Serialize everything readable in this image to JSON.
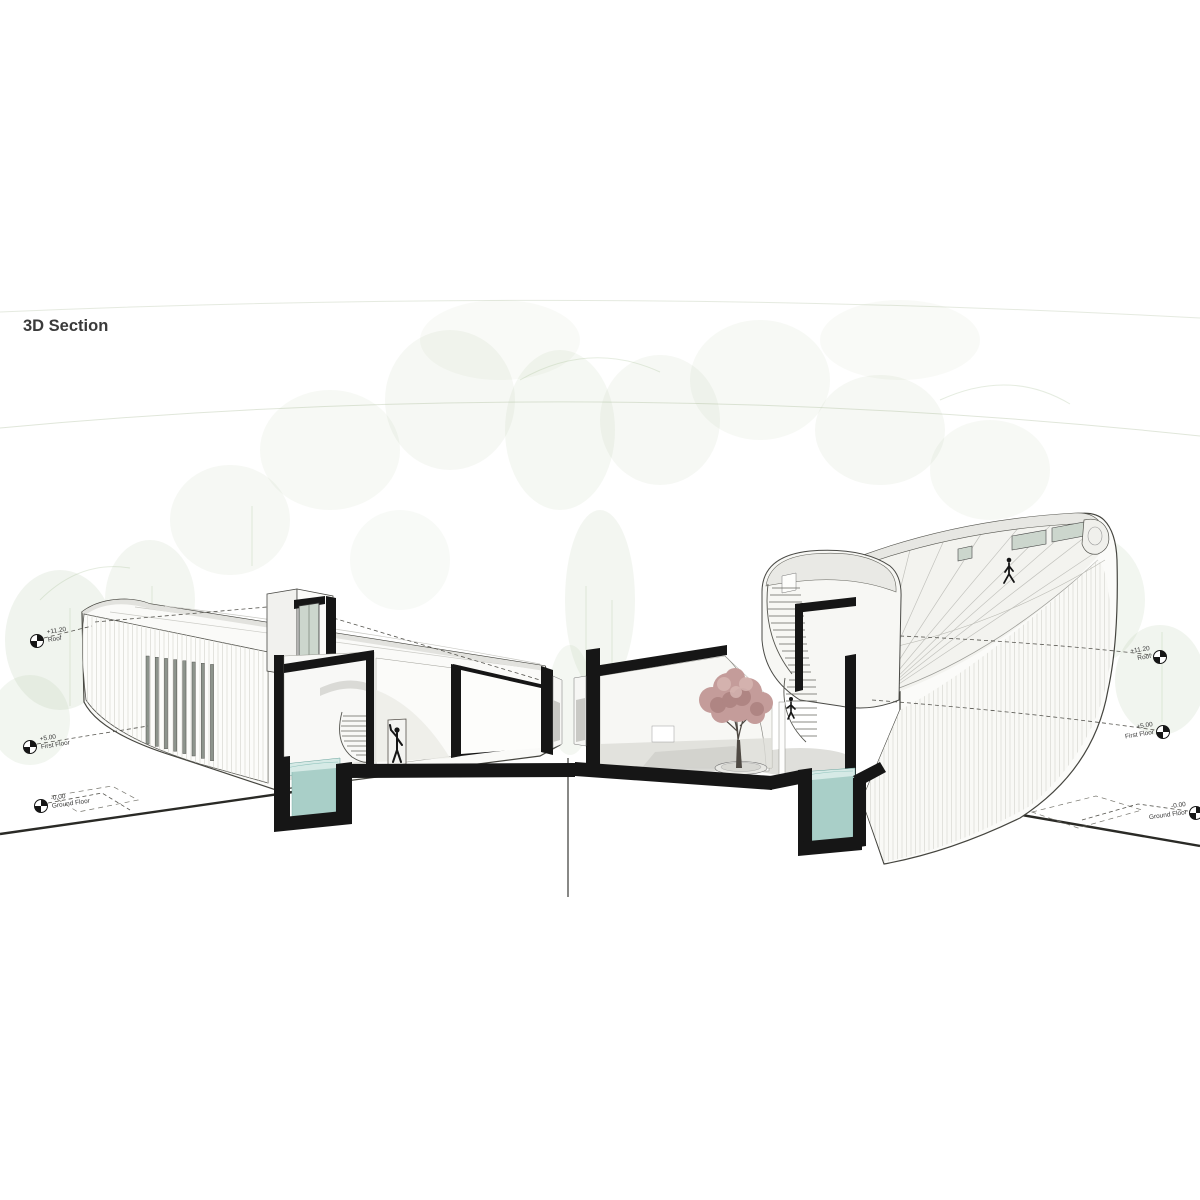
{
  "title": "3D Section",
  "levels": {
    "left": [
      {
        "value": "+11.20",
        "label": "Roof"
      },
      {
        "value": "+5.00",
        "label": "First Floor"
      },
      {
        "value": "-0.00",
        "label": "Ground Floor"
      }
    ],
    "right": [
      {
        "value": "+11.20",
        "label": "Roof"
      },
      {
        "value": "+5.00",
        "label": "First Floor"
      },
      {
        "value": "-0.00",
        "label": "Ground Floor"
      }
    ]
  },
  "scene": {
    "figures": [
      "person-in-doorway",
      "person-on-spiral-stair",
      "person-walking-on-roof"
    ],
    "features": [
      "left-building-half",
      "right-building-half",
      "reflecting-pool-left",
      "reflecting-pool-right",
      "courtyard-tree",
      "spiral-staircase-left",
      "spiral-staircase-right",
      "section-cut-axis"
    ]
  },
  "colors": {
    "paper": "#ffffff",
    "ink": "#161616",
    "outline": "#45453f",
    "text": "#3a3a3a",
    "forest": "#a4bd94",
    "forestLine": "#ccd6c2",
    "water": "#a9cfc8",
    "waterLight": "#d6eae6",
    "waterEdge": "#6aa39c",
    "tree": "#c49c9a",
    "treeDark": "#a87e7c",
    "glass": "#ccd6cd",
    "shadow": "#ecece8"
  }
}
